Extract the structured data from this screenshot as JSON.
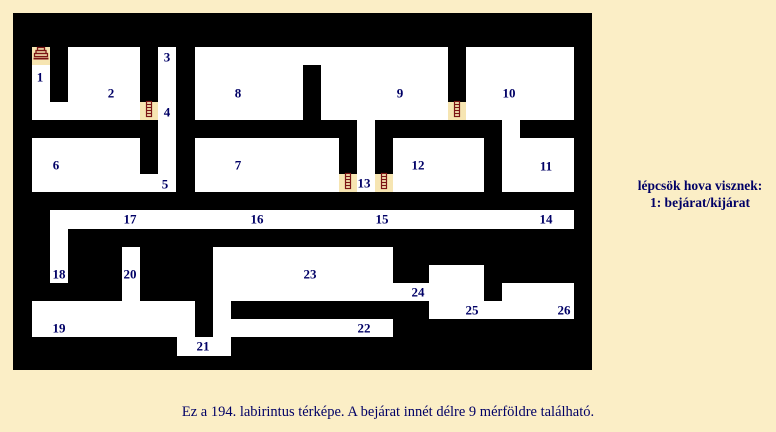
{
  "colors": {
    "page_bg": "#FBEEC6",
    "maze_wall": "#000000",
    "room_bg": "#FFFFFF",
    "stair_cell_bg": "#F6E5B2",
    "stair_icon": "#7B1414",
    "text": "#000066"
  },
  "maze": {
    "frame": {
      "x": 13,
      "y": 13,
      "w": 579,
      "h": 357
    },
    "rooms": [
      [
        32,
        47,
        18,
        73
      ],
      [
        68,
        47,
        72,
        55
      ],
      [
        32,
        102,
        108,
        18
      ],
      [
        158,
        47,
        18,
        145
      ],
      [
        195,
        47,
        253,
        73
      ],
      [
        466,
        47,
        108,
        73
      ],
      [
        502,
        120,
        18,
        18
      ],
      [
        32,
        138,
        108,
        54
      ],
      [
        140,
        174,
        36,
        18
      ],
      [
        195,
        138,
        144,
        54
      ],
      [
        357,
        120,
        18,
        72
      ],
      [
        393,
        138,
        91,
        54
      ],
      [
        502,
        138,
        72,
        54
      ],
      [
        50,
        210,
        524,
        19
      ],
      [
        50,
        229,
        18,
        54
      ],
      [
        122,
        247,
        18,
        54
      ],
      [
        32,
        301,
        163,
        36
      ],
      [
        177,
        337,
        54,
        19
      ],
      [
        213,
        301,
        18,
        36
      ],
      [
        213,
        247,
        180,
        54
      ],
      [
        231,
        319,
        162,
        18
      ],
      [
        393,
        283,
        36,
        18
      ],
      [
        429,
        265,
        55,
        54
      ],
      [
        484,
        301,
        18,
        18
      ],
      [
        502,
        283,
        72,
        36
      ]
    ],
    "walls": [
      [
        303,
        65,
        18,
        55
      ]
    ],
    "stairs": [
      {
        "icon": "stairs-icon",
        "x": 32,
        "y": 47,
        "w": 18,
        "h": 18
      },
      {
        "icon": "ladder-icon",
        "x": 140,
        "y": 102,
        "w": 18,
        "h": 18
      },
      {
        "icon": "ladder-icon",
        "x": 339,
        "y": 174,
        "w": 18,
        "h": 18
      },
      {
        "icon": "ladder-icon",
        "x": 375,
        "y": 174,
        "w": 18,
        "h": 18
      },
      {
        "icon": "ladder-icon",
        "x": 448,
        "y": 102,
        "w": 18,
        "h": 18
      }
    ],
    "labels": [
      {
        "n": "1",
        "x": 40,
        "y": 77
      },
      {
        "n": "2",
        "x": 111,
        "y": 93
      },
      {
        "n": "3",
        "x": 167,
        "y": 57
      },
      {
        "n": "4",
        "x": 167,
        "y": 112
      },
      {
        "n": "5",
        "x": 165,
        "y": 184
      },
      {
        "n": "6",
        "x": 56,
        "y": 165
      },
      {
        "n": "7",
        "x": 238,
        "y": 165
      },
      {
        "n": "8",
        "x": 238,
        "y": 93
      },
      {
        "n": "9",
        "x": 400,
        "y": 93
      },
      {
        "n": "10",
        "x": 509,
        "y": 93
      },
      {
        "n": "11",
        "x": 546,
        "y": 166
      },
      {
        "n": "12",
        "x": 418,
        "y": 165
      },
      {
        "n": "13",
        "x": 364,
        "y": 183
      },
      {
        "n": "14",
        "x": 546,
        "y": 219
      },
      {
        "n": "15",
        "x": 382,
        "y": 219
      },
      {
        "n": "16",
        "x": 257,
        "y": 219
      },
      {
        "n": "17",
        "x": 130,
        "y": 219
      },
      {
        "n": "18",
        "x": 59,
        "y": 274
      },
      {
        "n": "19",
        "x": 59,
        "y": 328
      },
      {
        "n": "20",
        "x": 130,
        "y": 274
      },
      {
        "n": "21",
        "x": 203,
        "y": 346
      },
      {
        "n": "22",
        "x": 364,
        "y": 328
      },
      {
        "n": "23",
        "x": 310,
        "y": 274
      },
      {
        "n": "24",
        "x": 418,
        "y": 292
      },
      {
        "n": "25",
        "x": 472,
        "y": 310
      },
      {
        "n": "26",
        "x": 564,
        "y": 310
      }
    ]
  },
  "legend": {
    "line1": "lépcsök hova visznek:",
    "line2": "1: bejárat/kijárat"
  },
  "caption": "Ez a 194. labirintus térképe. A bejárat innét délre 9 mérföldre található."
}
